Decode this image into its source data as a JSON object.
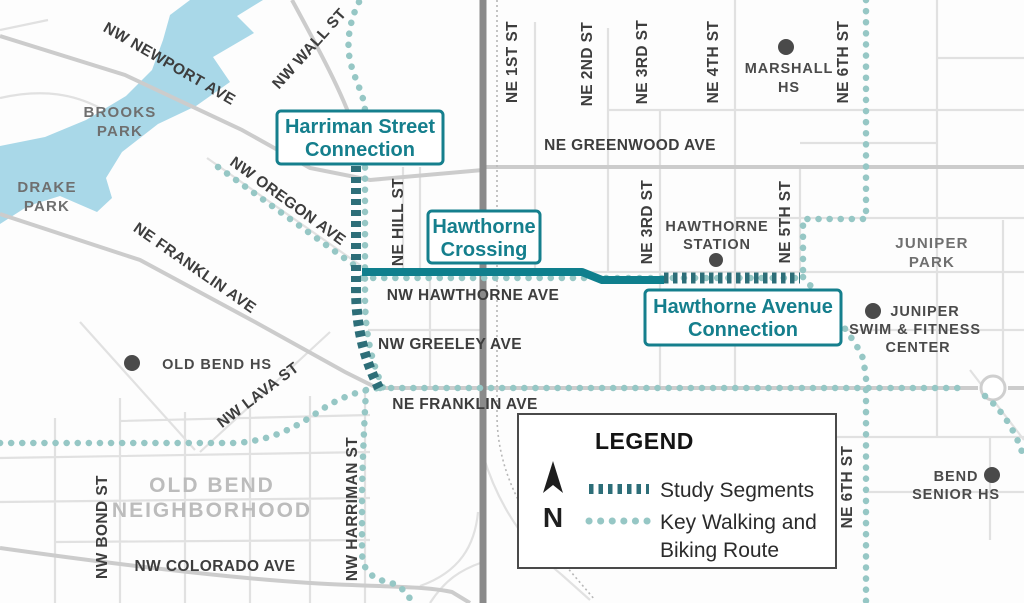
{
  "legend": {
    "title": "LEGEND",
    "north_label": "N",
    "items": [
      {
        "label_lines": [
          "Study Segments"
        ]
      },
      {
        "label_lines": [
          "Key Walking and",
          "Biking Route"
        ]
      }
    ]
  },
  "callouts": {
    "harriman": {
      "line1": "Harriman Street",
      "line2": "Connection"
    },
    "hawthorne_crossing": {
      "line1": "Hawthorne",
      "line2": "Crossing"
    },
    "hawthorne_avenue": {
      "line1": "Hawthorne Avenue",
      "line2": "Connection"
    }
  },
  "streets": {
    "nw_newport_ave": "NW NEWPORT AVE",
    "nw_wall_st": "NW WALL ST",
    "nw_oregon_ave": "NW OREGON AVE",
    "ne_franklin_ave_west": "NE FRANKLIN AVE",
    "ne_hill_st": "NE HILL ST",
    "ne_1st_st": "NE 1ST ST",
    "ne_2nd_st": "NE 2ND ST",
    "ne_3rd_st_north": "NE 3RD ST",
    "ne_4th_st": "NE 4TH ST",
    "ne_6th_st_north": "NE 6TH ST",
    "ne_greenwood_ave": "NE GREENWOOD AVE",
    "ne_3rd_st_mid": "NE 3RD ST",
    "ne_5th_st": "NE 5TH ST",
    "nw_hawthorne_ave": "NW HAWTHORNE AVE",
    "nw_greeley_ave": "NW GREELEY AVE",
    "ne_franklin_ave_east": "NE FRANKLIN AVE",
    "nw_lava_st": "NW LAVA ST",
    "nw_bond_st": "NW BOND ST",
    "nw_harriman_st": "NW HARRIMAN ST",
    "nw_colorado_ave": "NW COLORADO AVE",
    "ne_6th_st_south": "NE 6TH ST"
  },
  "parks": {
    "brooks": {
      "line1": "BROOKS",
      "line2": "PARK"
    },
    "drake": {
      "line1": "DRAKE",
      "line2": "PARK"
    },
    "juniper": {
      "line1": "JUNIPER",
      "line2": "PARK"
    }
  },
  "neighborhood": {
    "line1": "OLD BEND",
    "line2": "NEIGHBORHOOD"
  },
  "pois": {
    "marshall_hs": {
      "line1": "MARSHALL",
      "line2": "HS"
    },
    "old_bend_hs": {
      "label": "OLD BEND HS"
    },
    "hawthorne_station": {
      "line1": "HAWTHORNE",
      "line2": "STATION"
    },
    "juniper_swim": {
      "line1": "JUNIPER",
      "line2": "SWIM & FITNESS",
      "line3": "CENTER"
    },
    "bend_senior_hs": {
      "line1": "BEND",
      "line2": "SENIOR HS"
    }
  },
  "colors": {
    "study_segment": "#2d6e78",
    "walking_route": "#96c7c5",
    "corridor_solid": "#0f7f8d",
    "callout_teal": "#157f8d",
    "water": "#a9d8e8",
    "highway": "#8a8a8a",
    "legend_border": "#4a4a4a"
  }
}
